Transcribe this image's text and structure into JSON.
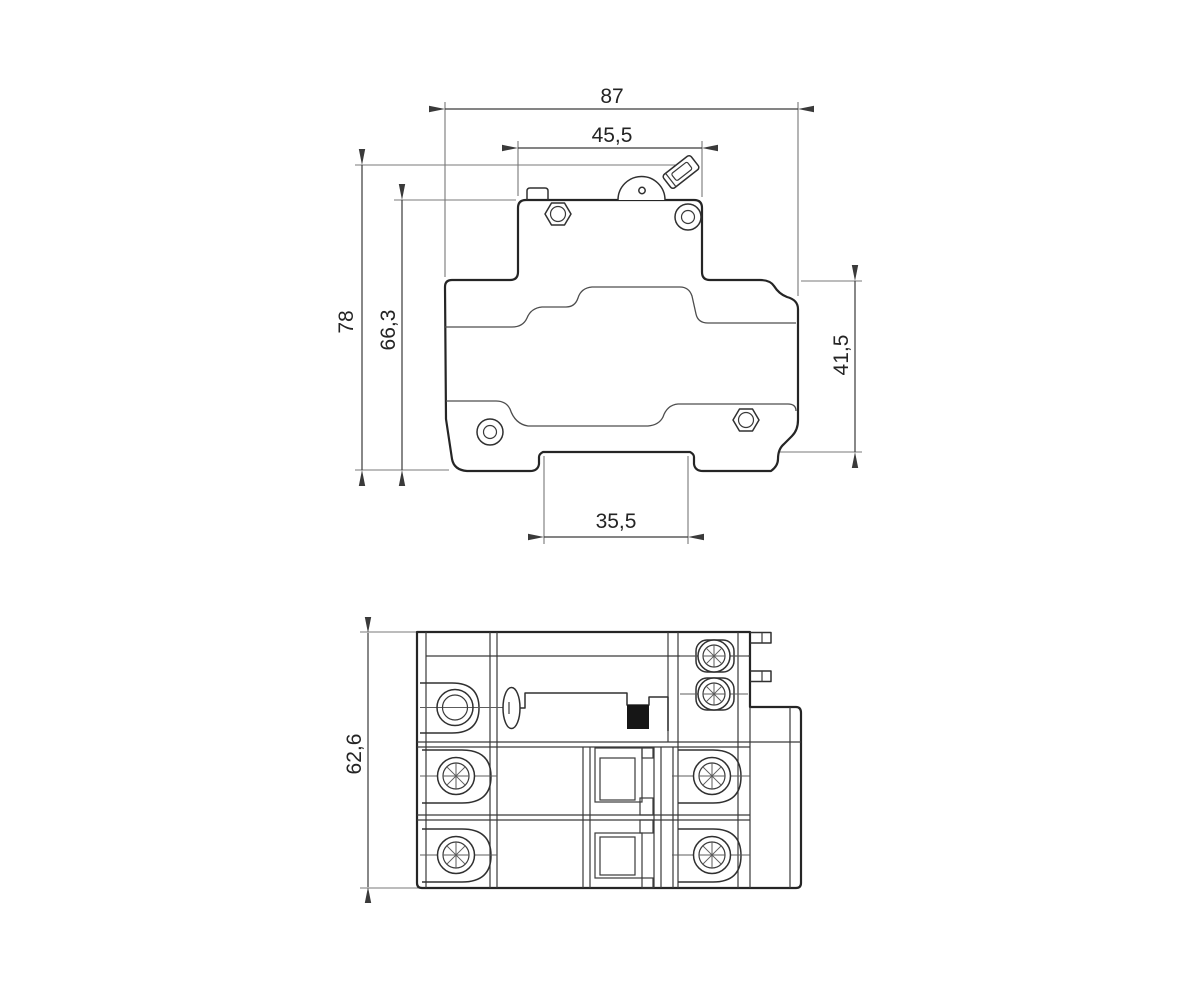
{
  "drawing": {
    "kind": "dimensional technical drawing, 2 views of a DIN-rail circuit breaker",
    "background_color": "#ffffff",
    "line_color": "#252525",
    "side_view": {
      "dimensions": {
        "overall_width": "87",
        "upper_body_width": "45,5",
        "overall_height": "78",
        "body_height": "66,3",
        "right_side_height": "41,5",
        "din_channel_width": "35,5"
      }
    },
    "top_view": {
      "dimensions": {
        "depth": "62,6"
      }
    }
  }
}
